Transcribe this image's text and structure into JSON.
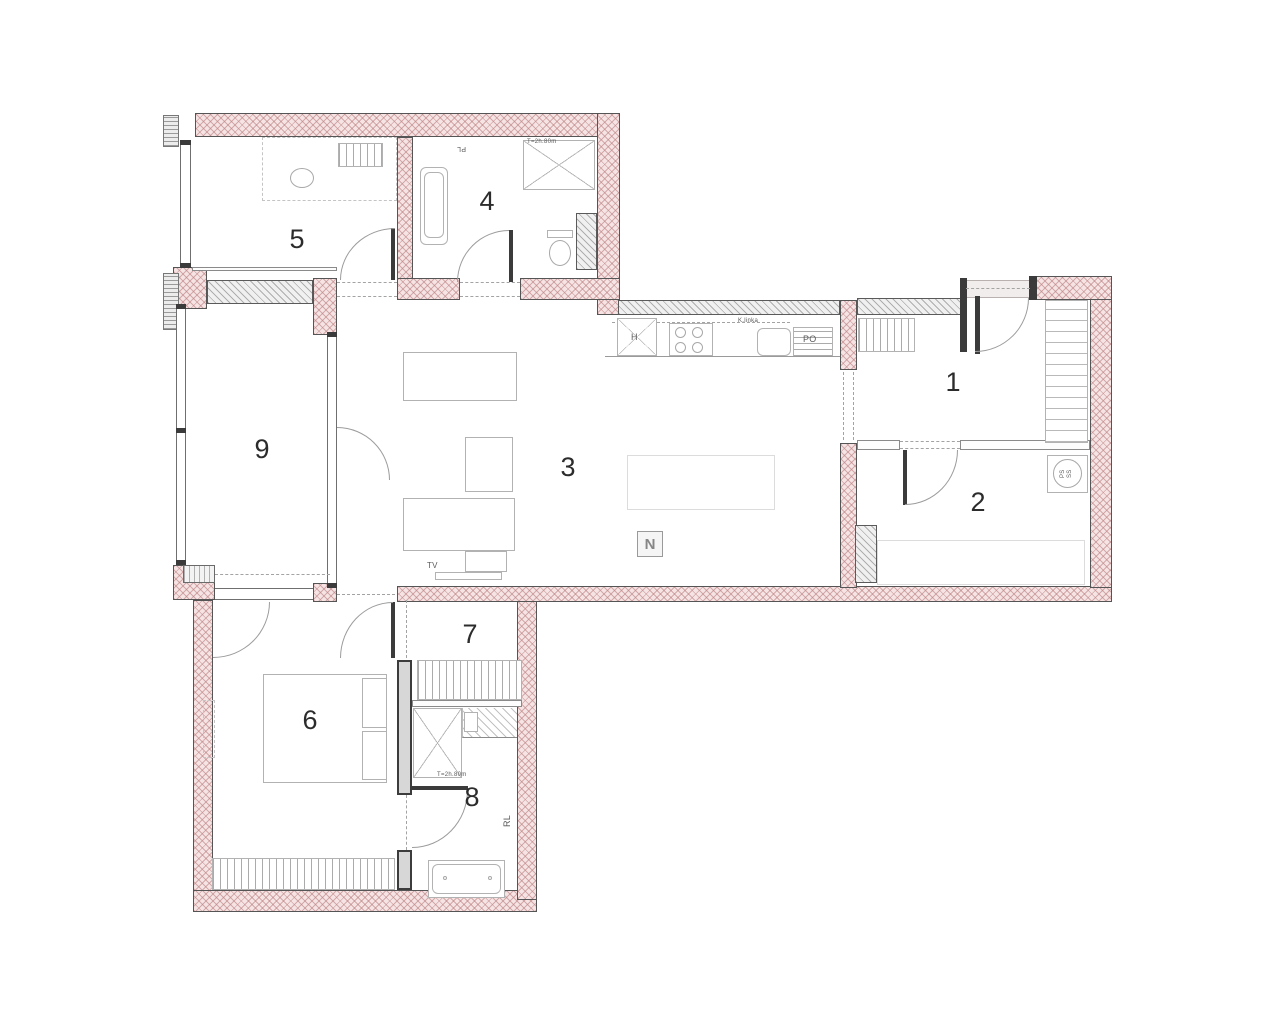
{
  "meta": {
    "type": "apartment-floor-plan",
    "room_numbers": [
      "1",
      "2",
      "3",
      "4",
      "5",
      "6",
      "7",
      "8",
      "9"
    ]
  },
  "colors": {
    "exterior_wall": "#f6e3e3",
    "exterior_hatch": "#bb8284",
    "interior_wall": "#f0f0f0",
    "interior_hatch": "#787878",
    "wall_border": "#555555",
    "furniture_line": "#b2b2b2",
    "dash_line": "#a3a3a3",
    "label": "#2c2c2c",
    "background": "#ffffff"
  },
  "plan": {
    "width": 1280,
    "height": 1033,
    "walls": [
      {
        "t": "ext",
        "x": 195,
        "y": 113,
        "w": 425,
        "h": 24
      },
      {
        "t": "ext",
        "x": 597,
        "y": 113,
        "w": 23,
        "h": 202
      },
      {
        "t": "ext",
        "x": 397,
        "y": 137,
        "w": 16,
        "h": 143
      },
      {
        "t": "ext",
        "x": 397,
        "y": 278,
        "w": 63,
        "h": 22
      },
      {
        "t": "ext",
        "x": 520,
        "y": 278,
        "w": 100,
        "h": 22
      },
      {
        "t": "ext",
        "x": 313,
        "y": 278,
        "w": 24,
        "h": 57
      },
      {
        "t": "ext",
        "x": 173,
        "y": 267,
        "w": 34,
        "h": 42
      },
      {
        "t": "ext",
        "x": 173,
        "y": 565,
        "w": 42,
        "h": 35
      },
      {
        "t": "ext",
        "x": 193,
        "y": 600,
        "w": 20,
        "h": 312
      },
      {
        "t": "ext",
        "x": 193,
        "y": 890,
        "w": 344,
        "h": 22
      },
      {
        "t": "ext",
        "x": 517,
        "y": 600,
        "w": 20,
        "h": 300
      },
      {
        "t": "ext",
        "x": 397,
        "y": 586,
        "w": 715,
        "h": 16
      },
      {
        "t": "ext",
        "x": 1090,
        "y": 298,
        "w": 22,
        "h": 290
      },
      {
        "t": "ext",
        "x": 1033,
        "y": 276,
        "w": 79,
        "h": 24
      },
      {
        "t": "ext",
        "x": 840,
        "y": 300,
        "w": 17,
        "h": 70
      },
      {
        "t": "ext",
        "x": 840,
        "y": 443,
        "w": 17,
        "h": 145
      },
      {
        "t": "ext",
        "x": 313,
        "y": 583,
        "w": 24,
        "h": 19
      },
      {
        "t": "int",
        "x": 207,
        "y": 280,
        "w": 106,
        "h": 24
      },
      {
        "t": "int",
        "x": 618,
        "y": 300,
        "w": 222,
        "h": 15
      },
      {
        "t": "int",
        "x": 857,
        "y": 298,
        "w": 106,
        "h": 17
      },
      {
        "t": "int",
        "x": 855,
        "y": 525,
        "w": 22,
        "h": 58
      },
      {
        "t": "int",
        "x": 576,
        "y": 213,
        "w": 21,
        "h": 57
      },
      {
        "t": "solid",
        "x": 397,
        "y": 660,
        "w": 15,
        "h": 135
      },
      {
        "t": "solid",
        "x": 397,
        "y": 850,
        "w": 15,
        "h": 40
      },
      {
        "t": "ins",
        "x": 183,
        "y": 565,
        "w": 32,
        "h": 18
      },
      {
        "t": "part",
        "x": 857,
        "y": 440,
        "w": 43,
        "h": 10
      },
      {
        "t": "part",
        "x": 960,
        "y": 440,
        "w": 130,
        "h": 10
      },
      {
        "t": "part",
        "x": 412,
        "y": 700,
        "w": 110,
        "h": 7
      },
      {
        "t": "part",
        "x": 192,
        "y": 267,
        "w": 145,
        "h": 4
      },
      {
        "t": "jamb",
        "x": 163,
        "y": 115,
        "w": 16,
        "h": 32
      },
      {
        "t": "jamb",
        "x": 163,
        "y": 273,
        "w": 16,
        "h": 57
      }
    ],
    "glazing": [
      {
        "o": "v",
        "x": 180,
        "y": 143,
        "w": 11,
        "h": 124
      },
      {
        "o": "v",
        "x": 176,
        "y": 307,
        "w": 10,
        "h": 258
      },
      {
        "o": "v",
        "x": 327,
        "y": 335,
        "w": 10,
        "h": 253
      },
      {
        "o": "h",
        "x": 215,
        "y": 588,
        "w": 98,
        "h": 12
      },
      {
        "o": "t",
        "x": 963,
        "y": 280,
        "w": 70,
        "h": 18
      }
    ],
    "posts": [
      {
        "x": 180,
        "y": 140,
        "w": 11,
        "h": 5
      },
      {
        "x": 180,
        "y": 263,
        "w": 11,
        "h": 5
      },
      {
        "x": 176,
        "y": 304,
        "w": 10,
        "h": 5
      },
      {
        "x": 176,
        "y": 560,
        "w": 10,
        "h": 5
      },
      {
        "x": 176,
        "y": 428,
        "w": 10,
        "h": 5
      },
      {
        "x": 327,
        "y": 332,
        "w": 10,
        "h": 5
      },
      {
        "x": 327,
        "y": 583,
        "w": 10,
        "h": 5
      },
      {
        "x": 960,
        "y": 278,
        "w": 7,
        "h": 74
      },
      {
        "x": 1029,
        "y": 276,
        "w": 8,
        "h": 24
      },
      {
        "x": 975,
        "y": 296,
        "w": 5,
        "h": 58
      },
      {
        "x": 903,
        "y": 450,
        "w": 4,
        "h": 55
      },
      {
        "x": 391,
        "y": 602,
        "w": 4,
        "h": 56
      },
      {
        "x": 412,
        "y": 786,
        "w": 56,
        "h": 4
      },
      {
        "x": 391,
        "y": 228,
        "w": 4,
        "h": 52
      },
      {
        "x": 509,
        "y": 230,
        "w": 4,
        "h": 52
      }
    ],
    "arcs": [
      {
        "x": 340,
        "y": 228,
        "w": 55,
        "h": 52,
        "c": "tl"
      },
      {
        "x": 457,
        "y": 230,
        "w": 52,
        "h": 52,
        "c": "tl"
      },
      {
        "x": 337,
        "y": 427,
        "w": 53,
        "h": 53,
        "c": "tr"
      },
      {
        "x": 975,
        "y": 298,
        "w": 54,
        "h": 54,
        "c": "br"
      },
      {
        "x": 905,
        "y": 450,
        "w": 53,
        "h": 55,
        "c": "br"
      },
      {
        "x": 213,
        "y": 602,
        "w": 57,
        "h": 56,
        "c": "br"
      },
      {
        "x": 340,
        "y": 602,
        "w": 53,
        "h": 56,
        "c": "tl"
      },
      {
        "x": 412,
        "y": 790,
        "w": 56,
        "h": 58,
        "c": "br"
      }
    ],
    "dashes": [
      {
        "o": "h",
        "x": 337,
        "y": 282,
        "l": 60
      },
      {
        "o": "h",
        "x": 337,
        "y": 296,
        "l": 60
      },
      {
        "o": "h",
        "x": 460,
        "y": 282,
        "l": 60
      },
      {
        "o": "h",
        "x": 460,
        "y": 296,
        "l": 60
      },
      {
        "o": "h",
        "x": 900,
        "y": 441,
        "l": 60
      },
      {
        "o": "h",
        "x": 900,
        "y": 448,
        "l": 60
      },
      {
        "o": "h",
        "x": 966,
        "y": 288,
        "l": 64
      },
      {
        "o": "h",
        "x": 612,
        "y": 322,
        "l": 178
      },
      {
        "o": "h",
        "x": 337,
        "y": 594,
        "l": 58
      },
      {
        "o": "h",
        "x": 215,
        "y": 574,
        "l": 115
      },
      {
        "o": "v",
        "x": 843,
        "y": 372,
        "l": 68
      },
      {
        "o": "v",
        "x": 853,
        "y": 372,
        "l": 68
      },
      {
        "o": "v",
        "x": 406,
        "y": 600,
        "l": 58
      },
      {
        "o": "v",
        "x": 406,
        "y": 795,
        "l": 55
      }
    ],
    "furniture": [
      {
        "k": "dashedf",
        "n": "desk-room5",
        "x": 262,
        "y": 137,
        "w": 135,
        "h": 64
      },
      {
        "k": "furn vstripes",
        "n": "shelf-room5",
        "x": 338,
        "y": 143,
        "w": 45,
        "h": 24
      },
      {
        "k": "ellipse",
        "n": "chair-room5",
        "x": 290,
        "y": 168,
        "w": 24,
        "h": 20
      },
      {
        "k": "furn round",
        "n": "bathtub-room4-outer",
        "x": 420,
        "y": 167,
        "w": 28,
        "h": 78
      },
      {
        "k": "furn round",
        "n": "bathtub-room4-inner",
        "x": 424,
        "y": 172,
        "w": 20,
        "h": 66
      },
      {
        "k": "furn xbox",
        "n": "shower-room4",
        "x": 523,
        "y": 140,
        "w": 72,
        "h": 50
      },
      {
        "k": "furn",
        "n": "toilet-tank",
        "x": 547,
        "y": 230,
        "w": 26,
        "h": 8
      },
      {
        "k": "ellipse",
        "n": "toilet-bowl",
        "x": 549,
        "y": 240,
        "w": 22,
        "h": 26
      },
      {
        "k": "furn xbox",
        "n": "kitchen-h-unit",
        "x": 617,
        "y": 318,
        "w": 40,
        "h": 38
      },
      {
        "k": "furn",
        "n": "hob",
        "x": 669,
        "y": 323,
        "w": 44,
        "h": 33
      },
      {
        "k": "ellipse",
        "n": "burner",
        "x": 675,
        "y": 327,
        "w": 11,
        "h": 11
      },
      {
        "k": "ellipse",
        "n": "burner",
        "x": 692,
        "y": 327,
        "w": 11,
        "h": 11
      },
      {
        "k": "ellipse",
        "n": "burner",
        "x": 675,
        "y": 342,
        "w": 11,
        "h": 11
      },
      {
        "k": "ellipse",
        "n": "burner",
        "x": 692,
        "y": 342,
        "w": 11,
        "h": 11
      },
      {
        "k": "furn round",
        "n": "kitchen-sink",
        "x": 757,
        "y": 328,
        "w": 34,
        "h": 28
      },
      {
        "k": "furn hstripes",
        "n": "dishwasher",
        "x": 793,
        "y": 327,
        "w": 40,
        "h": 30
      },
      {
        "k": "linef",
        "n": "counter-edge",
        "x": 605,
        "y": 356,
        "w": 235,
        "h": 1
      },
      {
        "k": "furn",
        "n": "sofa",
        "x": 403,
        "y": 352,
        "w": 114,
        "h": 49
      },
      {
        "k": "furn",
        "n": "armchair",
        "x": 465,
        "y": 437,
        "w": 48,
        "h": 55
      },
      {
        "k": "furn",
        "n": "sofa",
        "x": 403,
        "y": 498,
        "w": 112,
        "h": 53
      },
      {
        "k": "furn",
        "n": "sofa-chaise",
        "x": 465,
        "y": 551,
        "w": 42,
        "h": 21
      },
      {
        "k": "faint",
        "n": "dining-table",
        "x": 627,
        "y": 455,
        "w": 148,
        "h": 55
      },
      {
        "k": "furn",
        "n": "tv-console",
        "x": 435,
        "y": 572,
        "w": 67,
        "h": 8
      },
      {
        "k": "furn vstripes",
        "n": "closet-room1",
        "x": 858,
        "y": 318,
        "w": 57,
        "h": 34
      },
      {
        "k": "furn wardrobe",
        "n": "wardrobe-room1",
        "x": 1045,
        "y": 300,
        "w": 43,
        "h": 143
      },
      {
        "k": "furn",
        "n": "washing-machine",
        "x": 1047,
        "y": 455,
        "w": 41,
        "h": 38
      },
      {
        "k": "ellipse",
        "n": "washer-drum",
        "x": 1053,
        "y": 459,
        "w": 29,
        "h": 29
      },
      {
        "k": "faint",
        "n": "bed-room2",
        "x": 877,
        "y": 540,
        "w": 208,
        "h": 45
      },
      {
        "k": "furn",
        "n": "bed-room6",
        "x": 263,
        "y": 674,
        "w": 124,
        "h": 109
      },
      {
        "k": "furn",
        "n": "pillow",
        "x": 362,
        "y": 678,
        "w": 25,
        "h": 50
      },
      {
        "k": "furn",
        "n": "pillow",
        "x": 362,
        "y": 731,
        "w": 25,
        "h": 49
      },
      {
        "k": "furn vstripes",
        "n": "wardrobe-room6",
        "x": 212,
        "y": 858,
        "w": 183,
        "h": 32
      },
      {
        "k": "dashedf",
        "n": "radiator-room6",
        "x": 203,
        "y": 700,
        "w": 12,
        "h": 58
      },
      {
        "k": "furn vstripes",
        "n": "wardrobe-room7",
        "x": 417,
        "y": 660,
        "w": 105,
        "h": 40
      },
      {
        "k": "furn xbox",
        "n": "shower-room8",
        "x": 413,
        "y": 708,
        "w": 49,
        "h": 70
      },
      {
        "k": "hatchl",
        "n": "vanity-room8",
        "x": 462,
        "y": 708,
        "w": 55,
        "h": 30
      },
      {
        "k": "furn",
        "n": "basin-room8",
        "x": 464,
        "y": 712,
        "w": 14,
        "h": 20
      },
      {
        "k": "furn",
        "n": "bathtub-room8-outer",
        "x": 428,
        "y": 860,
        "w": 77,
        "h": 38
      },
      {
        "k": "furn round",
        "n": "bathtub-room8-inner",
        "x": 432,
        "y": 864,
        "w": 69,
        "h": 30
      },
      {
        "k": "ellipse",
        "n": "drain",
        "x": 443,
        "y": 876,
        "w": 4,
        "h": 4
      },
      {
        "k": "ellipse",
        "n": "drain",
        "x": 488,
        "y": 876,
        "w": 4,
        "h": 4
      },
      {
        "k": "compass",
        "n": "north-indicator",
        "x": 637,
        "y": 531,
        "w": 26,
        "h": 26,
        "text": "N"
      }
    ],
    "labels": [
      {
        "text": "5",
        "x": 297,
        "y": 226
      },
      {
        "text": "4",
        "x": 487,
        "y": 188
      },
      {
        "text": "9",
        "x": 262,
        "y": 436
      },
      {
        "text": "3",
        "x": 568,
        "y": 454
      },
      {
        "text": "1",
        "x": 953,
        "y": 369
      },
      {
        "text": "2",
        "x": 978,
        "y": 489
      },
      {
        "text": "7",
        "x": 470,
        "y": 621
      },
      {
        "text": "6",
        "x": 310,
        "y": 707
      },
      {
        "text": "8",
        "x": 472,
        "y": 784
      }
    ],
    "annotations": [
      {
        "text": "PL",
        "x": 466,
        "y": 152,
        "s": 7,
        "r": 180
      },
      {
        "text": "T=2h.80m",
        "x": 527,
        "y": 139,
        "s": 6,
        "r": 0
      },
      {
        "text": "K.linka",
        "x": 738,
        "y": 318,
        "s": 6,
        "r": 0
      },
      {
        "text": "H",
        "x": 631,
        "y": 333,
        "s": 9,
        "r": 0
      },
      {
        "text": "PO",
        "x": 803,
        "y": 335,
        "s": 9,
        "r": 0
      },
      {
        "text": "PS",
        "x": 1060,
        "y": 478,
        "s": 6,
        "r": -90
      },
      {
        "text": "SS",
        "x": 1067,
        "y": 478,
        "s": 6,
        "r": -90
      },
      {
        "text": "TV",
        "x": 427,
        "y": 562,
        "s": 8,
        "r": 0
      },
      {
        "text": "T=2h.80m",
        "x": 437,
        "y": 772,
        "s": 6,
        "r": 0
      },
      {
        "text": "RL",
        "x": 503,
        "y": 827,
        "s": 9,
        "r": -90
      }
    ]
  }
}
